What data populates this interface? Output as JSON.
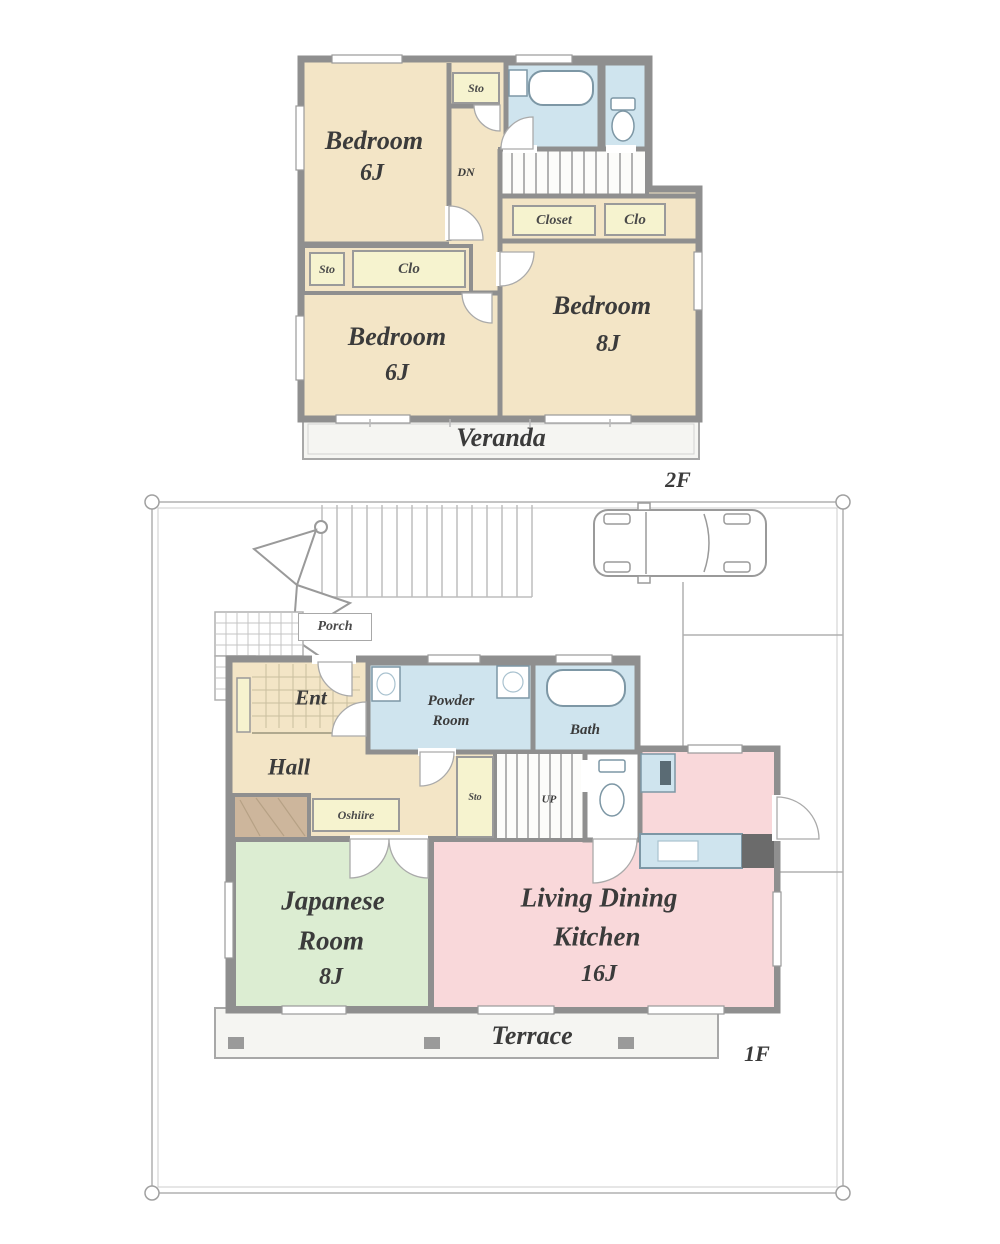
{
  "floor_2f": {
    "floor_label": "2F",
    "veranda_label": "Veranda",
    "stairs_label": "DN",
    "rooms": {
      "bedroom_nw": {
        "name": "Bedroom",
        "size": "6J"
      },
      "bedroom_sw": {
        "name": "Bedroom",
        "size": "6J"
      },
      "bedroom_e": {
        "name": "Bedroom",
        "size": "8J"
      }
    },
    "closets": {
      "sto_top": "Sto",
      "closet_e": "Closet",
      "clo_e": "Clo",
      "sto_w": "Sto",
      "clo_w": "Clo"
    }
  },
  "floor_1f": {
    "floor_label": "1F",
    "terrace_label": "Terrace",
    "porch_label": "Porch",
    "stairs_label": "UP",
    "rooms": {
      "entrance": {
        "name": "Ent"
      },
      "hall": {
        "name": "Hall"
      },
      "powder_room": {
        "line1": "Powder",
        "line2": "Room"
      },
      "bath": {
        "name": "Bath"
      },
      "japanese_room": {
        "line1": "Japanese",
        "line2": "Room",
        "size": "8J"
      },
      "ldk": {
        "line1": "Living Dining",
        "line2": "Kitchen",
        "size": "16J"
      }
    },
    "closets": {
      "sto": "Sto",
      "oshiire": "Oshiire"
    }
  },
  "colors": {
    "wall": "#8f8f8f",
    "room_cream": "#f3e5c6",
    "wet_area_blue": "#cfe4ee",
    "tatami_green": "#dcedd2",
    "ldk_pink": "#f9d8da",
    "closet_yellow": "#f6f3cf",
    "tokonoma_brown": "#cdb69c",
    "site_line": "#b0b0b0"
  }
}
